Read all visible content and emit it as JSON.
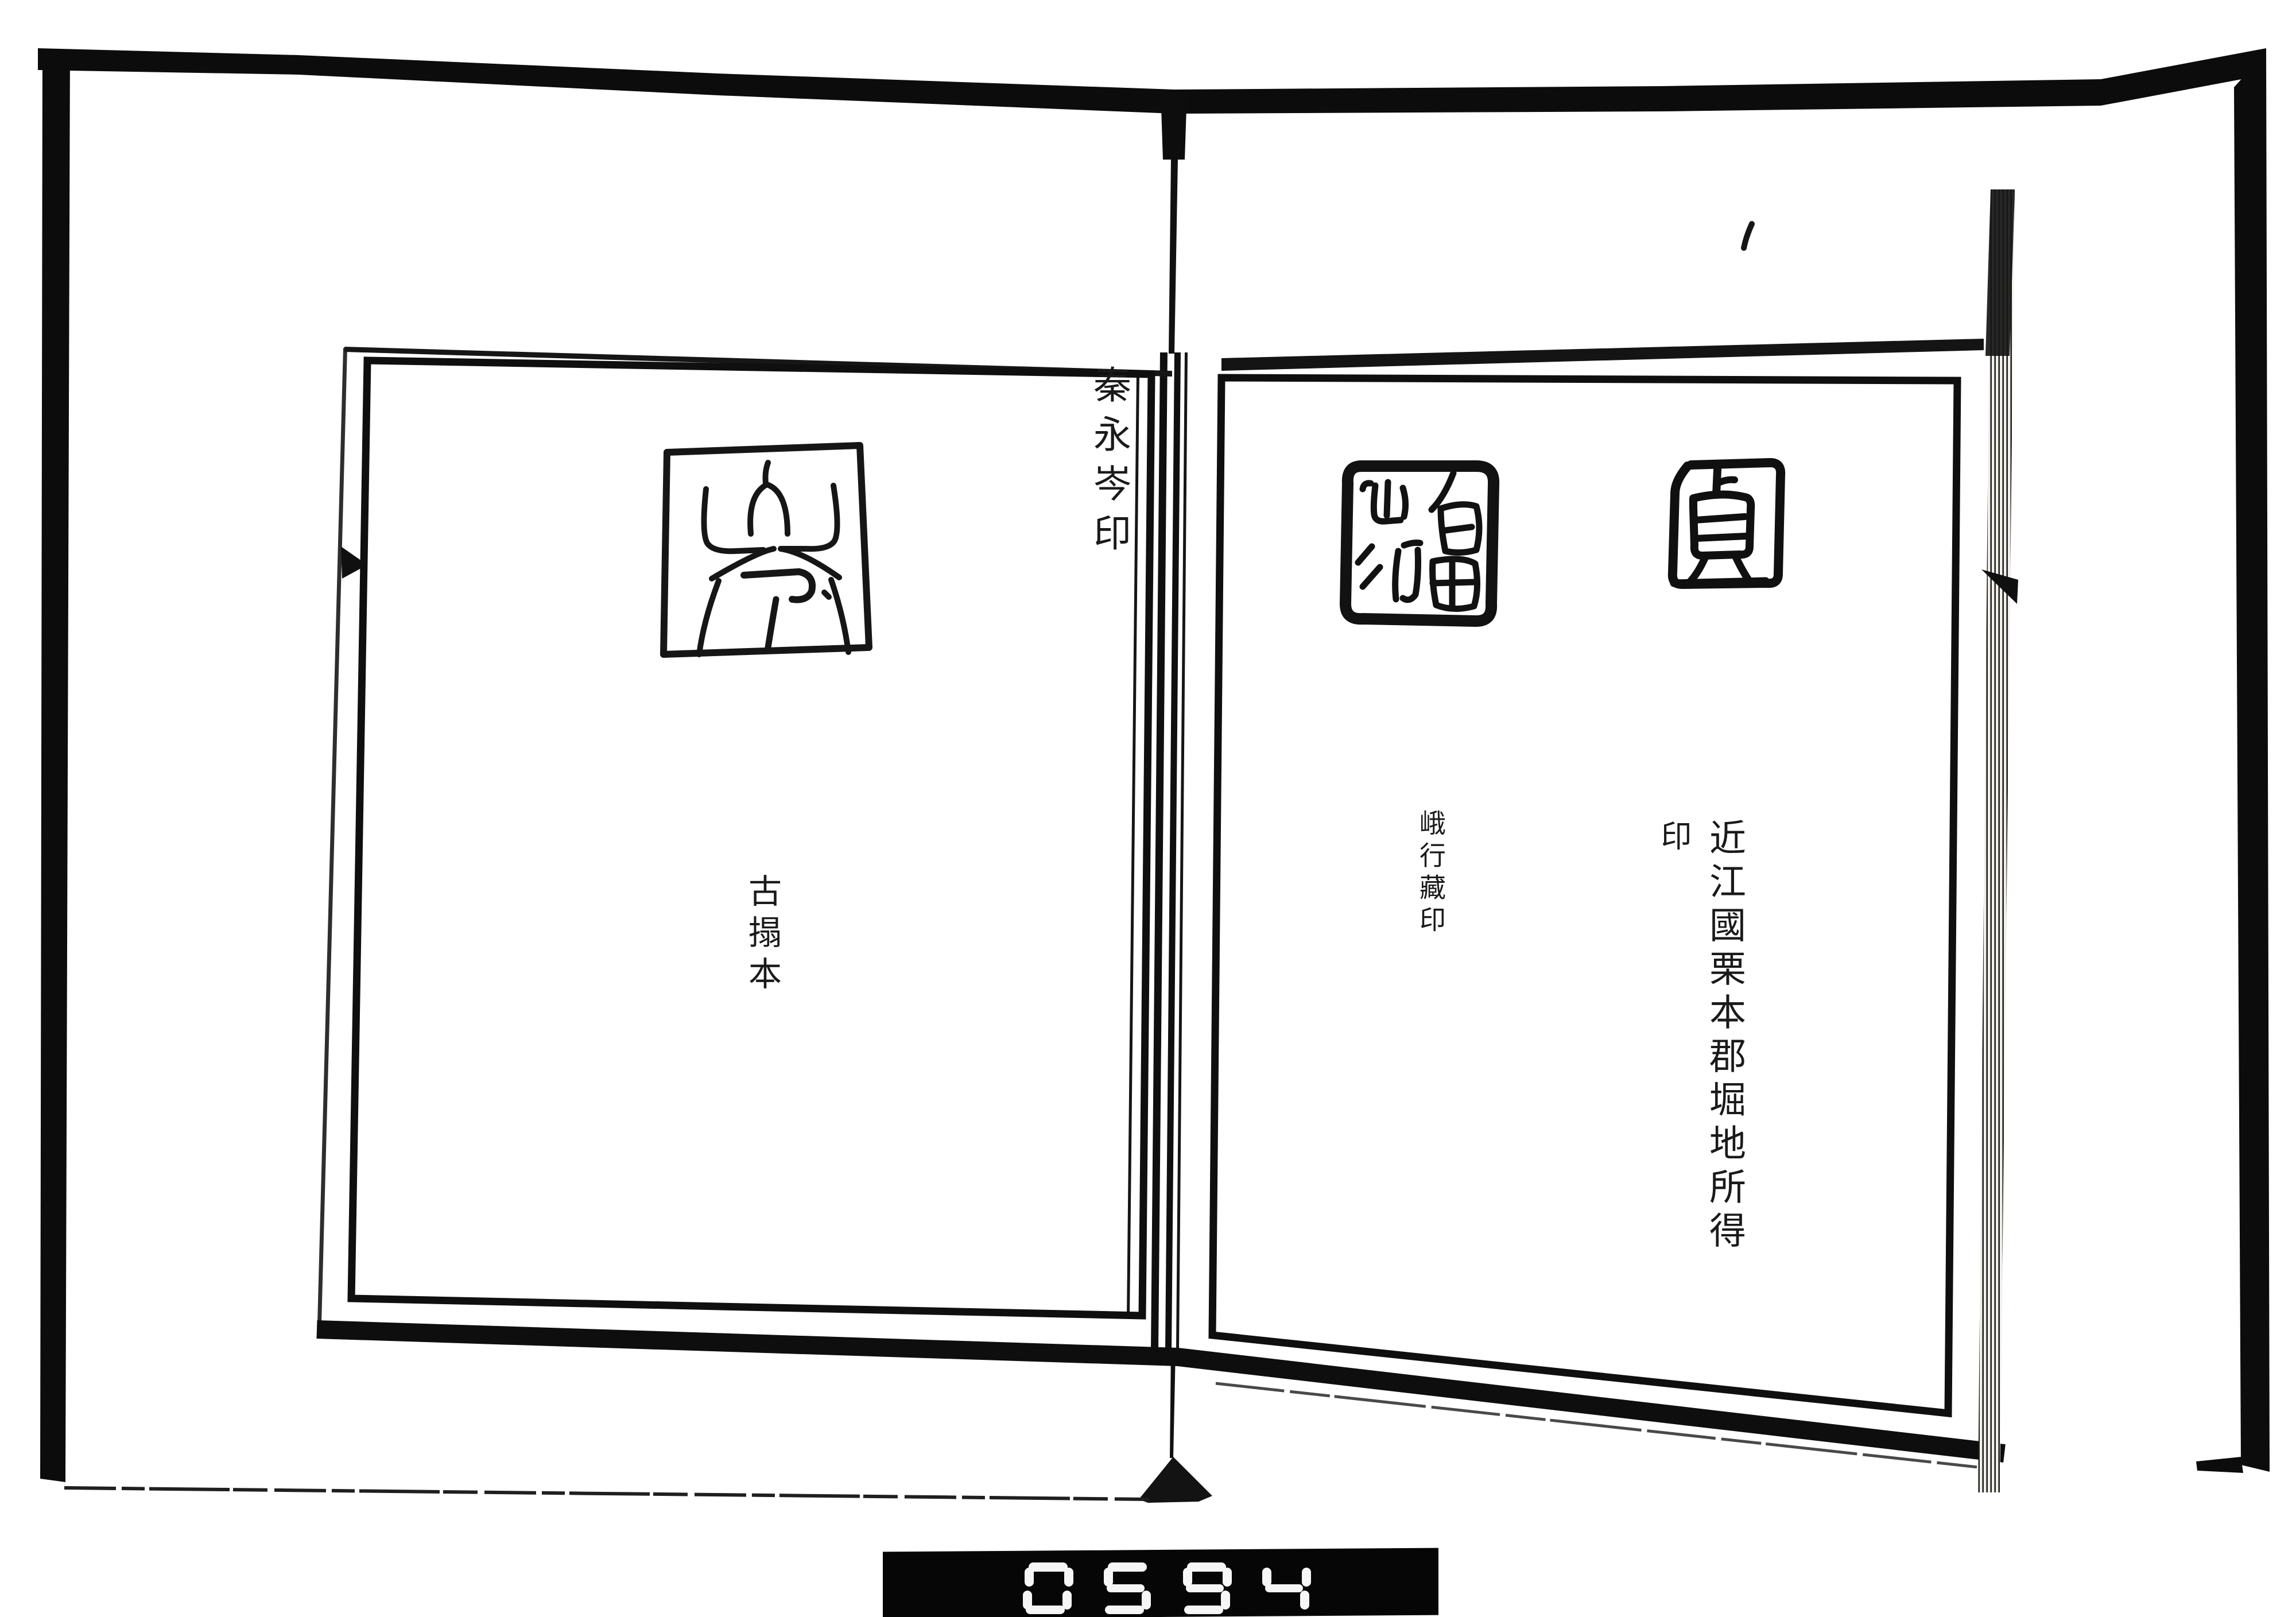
{
  "colors": {
    "ink": "#1a1a1a",
    "paper": "#ffffff",
    "scan_border": "#0c0c0c",
    "counter_background": "#060606",
    "counter_digit": "#f6f6f6"
  },
  "left_page": {
    "seal_label": "秦永岑印",
    "note": "古搨本",
    "seal_glyph": "岑"
  },
  "right_page": {
    "provenance_main": "近江國栗本郡堀地所得",
    "provenance_cont": "印",
    "collection_note": "峨行藏印",
    "seal_left_glyphs": "有田山行",
    "seal_right_glyph": "貞"
  },
  "counter": {
    "value": "0594"
  }
}
